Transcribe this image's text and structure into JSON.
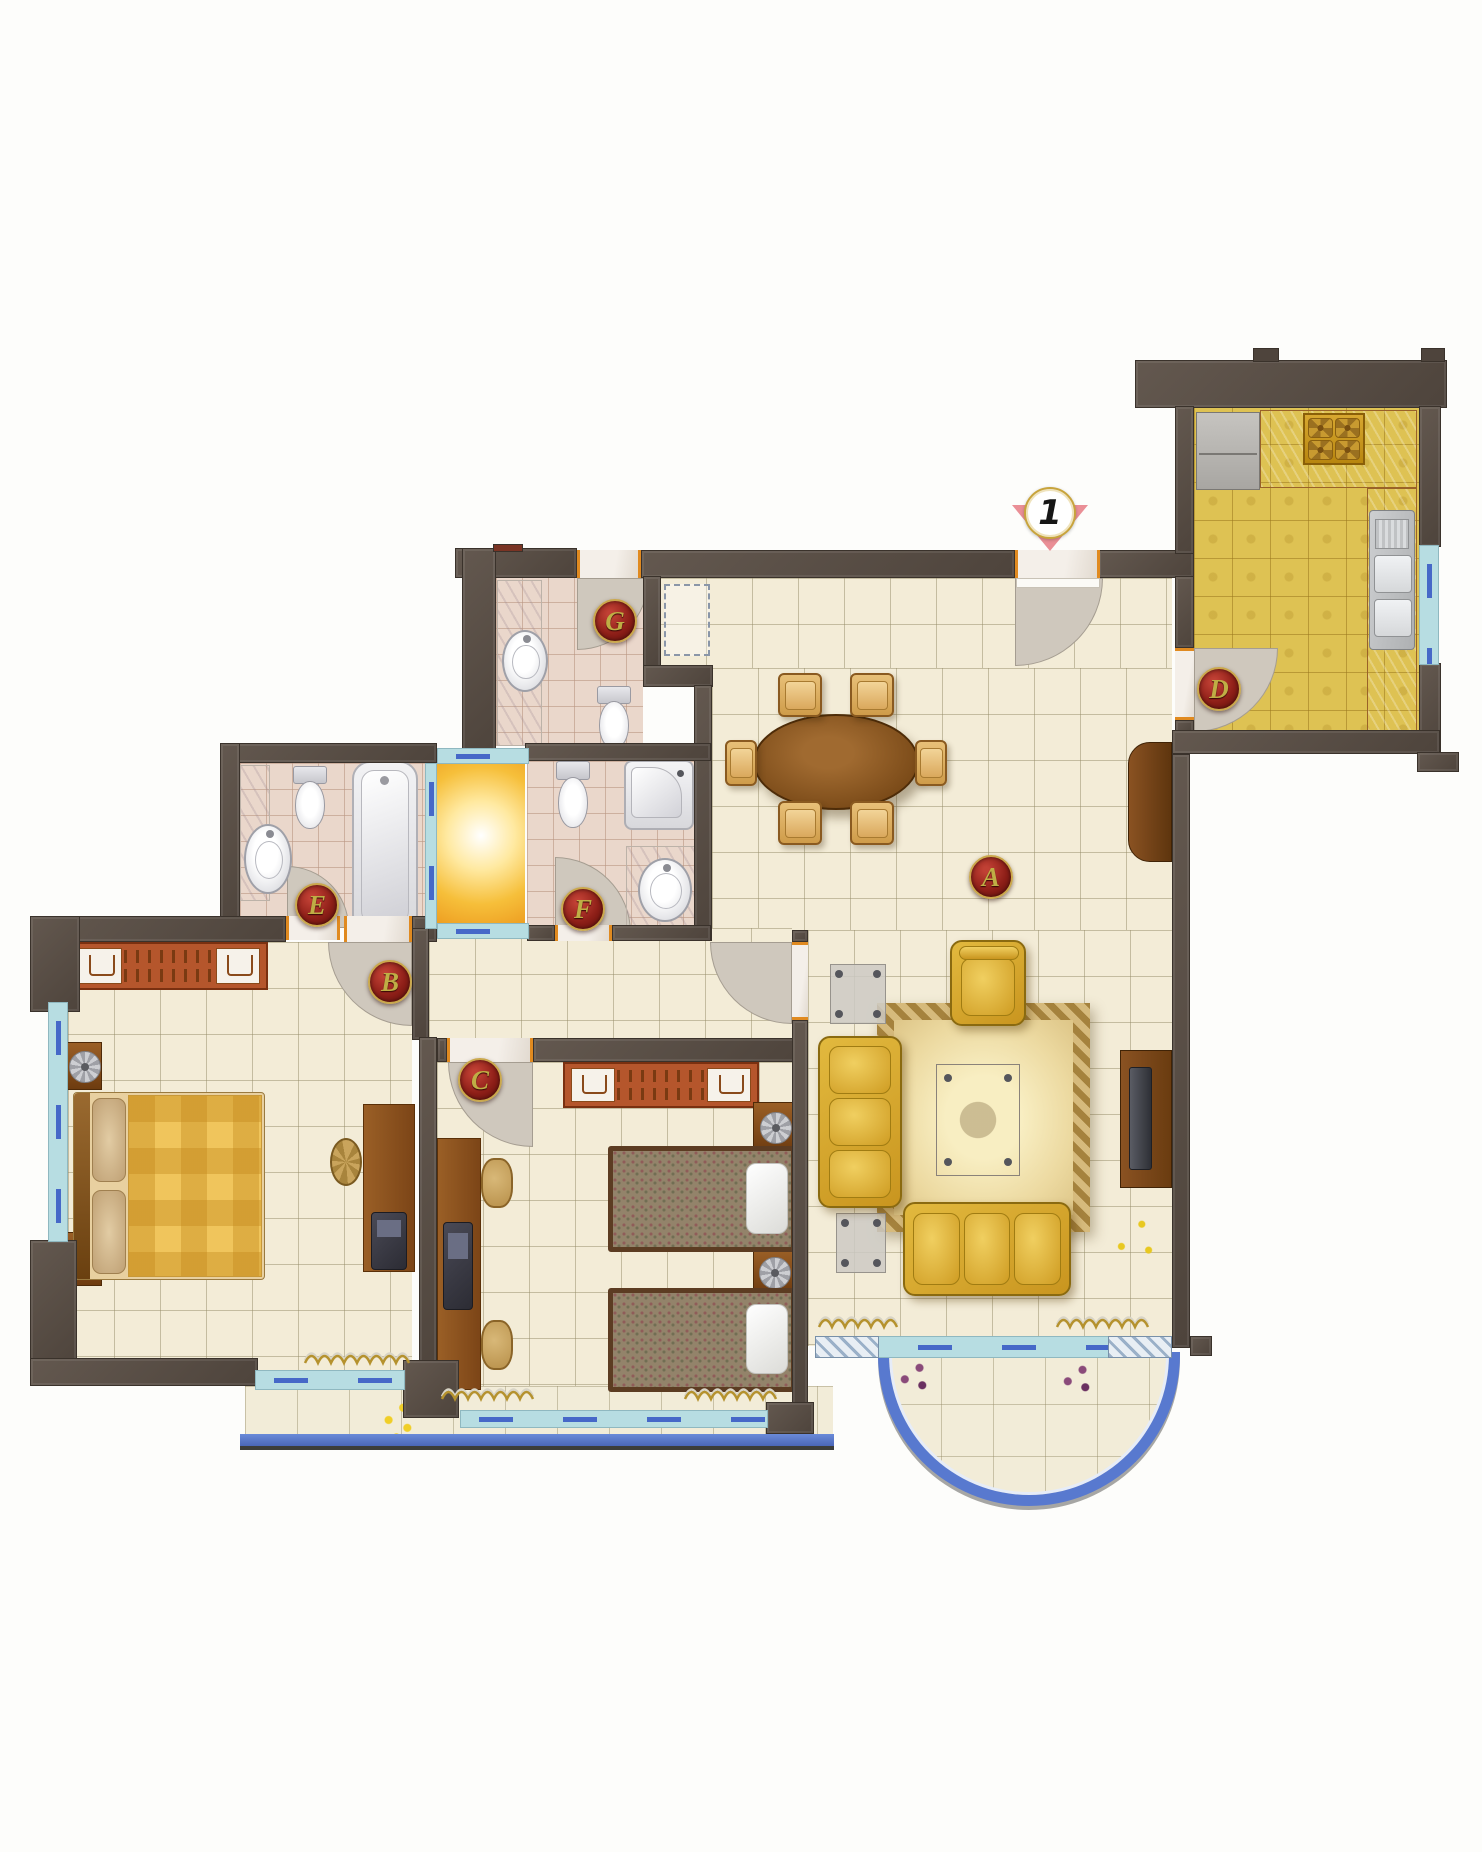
{
  "marker": {
    "text": "1",
    "x": 1050,
    "y": 513,
    "name": "entrance-marker"
  },
  "room_labels": [
    {
      "letter": "A",
      "x": 991,
      "y": 877,
      "name": "label-living-dining-A"
    },
    {
      "letter": "B",
      "x": 390,
      "y": 982,
      "name": "label-bedroom-master-B"
    },
    {
      "letter": "C",
      "x": 480,
      "y": 1080,
      "name": "label-bedroom-2-C"
    },
    {
      "letter": "D",
      "x": 1219,
      "y": 689,
      "name": "label-kitchen-D"
    },
    {
      "letter": "E",
      "x": 317,
      "y": 905,
      "name": "label-bath-e-E"
    },
    {
      "letter": "F",
      "x": 583,
      "y": 909,
      "name": "label-bath-f-F"
    },
    {
      "letter": "G",
      "x": 615,
      "y": 621,
      "name": "label-bath-g-G"
    }
  ],
  "colors": {
    "wall": "#574c44",
    "floor_cream": "#f3ecd7",
    "floor_bath": "#ead7cb",
    "floor_kitchen": "#dec253",
    "lightwell": "#f6bf3a",
    "window": "#b7dde2",
    "window_dash": "#4668c8",
    "balcony_edge": "#5879cf",
    "door_swing": "#cfc8bd",
    "label_red": "#8e1f18",
    "label_gold": "#bfae45",
    "marker_pink": "#ea8f96",
    "sofa_gold": "#d8a82c",
    "wood": "#8a5a2a",
    "wardrobe_orange": "#b5562c"
  },
  "floors": [
    [
      660,
      578,
      512,
      92,
      "cream",
      "foyer-floor"
    ],
    [
      712,
      668,
      460,
      272,
      "cream",
      "dining-floor"
    ],
    [
      808,
      930,
      364,
      416,
      "cream",
      "living-floor"
    ],
    [
      429,
      928,
      363,
      112,
      "cream",
      "hall-floor"
    ],
    [
      68,
      942,
      344,
      430,
      "cream",
      "bedroom-master-floor"
    ],
    [
      437,
      1062,
      355,
      348,
      "cream",
      "bedroom-2-floor"
    ],
    [
      496,
      576,
      147,
      170,
      "bath",
      "bath-g-floor"
    ],
    [
      527,
      761,
      167,
      164,
      "bath",
      "bath-f-floor"
    ],
    [
      240,
      763,
      185,
      154,
      "bath",
      "bath-e-floor"
    ],
    [
      1194,
      406,
      225,
      326,
      "kitchen",
      "kitchen-floor"
    ],
    [
      245,
      1386,
      588,
      50,
      "balcony",
      "balcony-left-floor"
    ],
    [
      437,
      764,
      88,
      159,
      "glow",
      "lightwell"
    ]
  ],
  "walls": [
    [
      455,
      548,
      122,
      30
    ],
    [
      641,
      550,
      374,
      28
    ],
    [
      1098,
      550,
      96,
      28
    ],
    [
      462,
      548,
      34,
      206
    ],
    [
      643,
      576,
      18,
      95
    ],
    [
      643,
      665,
      70,
      22
    ],
    [
      694,
      685,
      18,
      256
    ],
    [
      525,
      743,
      186,
      18
    ],
    [
      220,
      743,
      217,
      20
    ],
    [
      220,
      743,
      20,
      196
    ],
    [
      240,
      917,
      46,
      22
    ],
    [
      527,
      925,
      28,
      16
    ],
    [
      612,
      925,
      99,
      16
    ],
    [
      30,
      916,
      256,
      26
    ],
    [
      412,
      916,
      25,
      26
    ],
    [
      412,
      928,
      17,
      112
    ],
    [
      419,
      1037,
      18,
      357
    ],
    [
      437,
      1038,
      10,
      24
    ],
    [
      533,
      1038,
      269,
      24
    ],
    [
      792,
      930,
      16,
      12
    ],
    [
      792,
      1020,
      16,
      414
    ],
    [
      30,
      916,
      50,
      96
    ],
    [
      30,
      1240,
      47,
      128
    ],
    [
      30,
      1358,
      228,
      28
    ],
    [
      403,
      1360,
      56,
      58
    ],
    [
      766,
      1402,
      48,
      32
    ],
    [
      1135,
      360,
      312,
      48
    ],
    [
      1175,
      406,
      19,
      148
    ],
    [
      1175,
      576,
      19,
      72
    ],
    [
      1175,
      720,
      19,
      14
    ],
    [
      1419,
      406,
      22,
      141
    ],
    [
      1419,
      663,
      22,
      92
    ],
    [
      1172,
      730,
      268,
      24
    ],
    [
      1417,
      752,
      42,
      20
    ],
    [
      1172,
      754,
      18,
      594
    ],
    [
      1190,
      1336,
      22,
      20
    ]
  ],
  "caps": [
    [
      493,
      544,
      30,
      8,
      "#7a3424",
      "roof-cap-red"
    ],
    [
      1253,
      348,
      26,
      14,
      "#4e443c",
      "kitchen-wall-stub-1"
    ],
    [
      1421,
      348,
      24,
      14,
      "#4e443c",
      "kitchen-wall-stub-2"
    ]
  ],
  "windows": [
    [
      48,
      1002,
      20,
      240,
      "v",
      "bedroom-master-side-window"
    ],
    [
      255,
      1370,
      150,
      20,
      "h",
      "bedroom-master-balcony-window"
    ],
    [
      460,
      1410,
      308,
      18,
      "h",
      "bedroom-2-balcony-window"
    ],
    [
      815,
      1336,
      357,
      22,
      "h",
      "living-room-balcony-window"
    ],
    [
      815,
      1336,
      64,
      22,
      "hatch",
      "living-window-sill-left"
    ],
    [
      1108,
      1336,
      64,
      22,
      "hatch",
      "living-window-sill-right"
    ],
    [
      1419,
      545,
      20,
      120,
      "v",
      "kitchen-window"
    ],
    [
      425,
      763,
      12,
      166,
      "v",
      "lightwell-window-left"
    ],
    [
      437,
      748,
      92,
      16,
      "h",
      "lightwell-window-top"
    ],
    [
      437,
      923,
      92,
      16,
      "h",
      "lightwell-window-bottom"
    ]
  ],
  "door_swings": [
    [
      1015,
      578,
      88,
      "br",
      "entrance-door-swing"
    ],
    [
      1194,
      648,
      84,
      "br",
      "kitchen-door-swing"
    ],
    [
      577,
      578,
      72,
      "br",
      "bath-g-door-swing"
    ],
    [
      555,
      857,
      76,
      "tr",
      "bath-f-door-swing"
    ],
    [
      287,
      866,
      62,
      "tr",
      "bath-e-door-swing"
    ],
    [
      328,
      942,
      84,
      "bl",
      "bedroom-master-door-swing"
    ],
    [
      448,
      1062,
      85,
      "bl",
      "bedroom-2-door-swing"
    ],
    [
      710,
      942,
      82,
      "bl",
      "living-hall-door-swing"
    ]
  ],
  "thresholds": [
    [
      1015,
      550,
      85,
      28,
      0,
      "entrance-threshold"
    ],
    [
      577,
      550,
      64,
      28,
      0,
      "bath-g-threshold"
    ],
    [
      1175,
      648,
      19,
      72,
      1,
      "kitchen-threshold"
    ],
    [
      286,
      916,
      54,
      24,
      0,
      "bath-e-threshold"
    ],
    [
      344,
      916,
      68,
      26,
      0,
      "bedroom-master-threshold"
    ],
    [
      555,
      925,
      57,
      16,
      0,
      "bath-f-threshold"
    ],
    [
      447,
      1038,
      86,
      24,
      0,
      "bedroom-2-threshold"
    ],
    [
      792,
      942,
      16,
      78,
      1,
      "living-hall-threshold"
    ]
  ],
  "leafs": [
    [
      1016,
      578,
      84,
      10,
      "entrance-door-leaf"
    ]
  ],
  "dashed_boxes": [
    [
      664,
      584,
      46,
      72,
      "foyer-closet-outline"
    ]
  ],
  "furniture": [
    [
      "rug",
      877,
      1003,
      213,
      229,
      "living-rug"
    ],
    [
      "fridge",
      1196,
      412,
      64,
      78,
      "kitchen-fridge"
    ],
    [
      "counter",
      1260,
      410,
      157,
      78,
      "kitchen-counter-top"
    ],
    [
      "stove",
      1303,
      413,
      62,
      52,
      "kitchen-stove"
    ],
    [
      "counter",
      1367,
      488,
      50,
      244,
      "kitchen-counter-right"
    ],
    [
      "sink",
      1369,
      510,
      46,
      140,
      "kitchen-sink"
    ],
    [
      "marble",
      497,
      580,
      45,
      166,
      "bath-g-counter"
    ],
    [
      "basin",
      502,
      630,
      46,
      62,
      "bath-g-basin"
    ],
    [
      "toilet",
      594,
      686,
      38,
      62,
      "bath-g-toilet"
    ],
    [
      "toilet",
      553,
      761,
      38,
      66,
      "bath-f-toilet"
    ],
    [
      "shower",
      624,
      760,
      70,
      70,
      "bath-f-shower"
    ],
    [
      "marble",
      626,
      846,
      82,
      90,
      "bath-f-counter"
    ],
    [
      "basin",
      638,
      858,
      54,
      64,
      "bath-f-basin"
    ],
    [
      "marble",
      240,
      765,
      30,
      136,
      "bath-e-counter"
    ],
    [
      "basin",
      244,
      824,
      48,
      70,
      "bath-e-basin"
    ],
    [
      "toilet",
      290,
      766,
      38,
      62,
      "bath-e-toilet"
    ],
    [
      "tub",
      352,
      761,
      66,
      172,
      "bath-e-tub"
    ],
    [
      "ward",
      70,
      942,
      198,
      48,
      "master-wardrobe"
    ],
    [
      "nstand",
      66,
      1042,
      36,
      48,
      "master-nightstand-top"
    ],
    [
      "nstand",
      66,
      1232,
      36,
      54,
      "master-nightstand-bottom"
    ],
    [
      "bedm",
      73,
      1092,
      192,
      188,
      "master-bed"
    ],
    [
      "desk",
      363,
      1104,
      52,
      168,
      "master-desk"
    ],
    [
      "stool",
      330,
      1138,
      32,
      48,
      "master-desk-stool"
    ],
    [
      "laptop",
      371,
      1212,
      36,
      58,
      "master-desk-chair"
    ],
    [
      "ward",
      563,
      1062,
      196,
      46,
      "bedroom2-wardrobe"
    ],
    [
      "desk",
      437,
      1138,
      44,
      252,
      "bedroom2-desk"
    ],
    [
      "chairw",
      481,
      1158,
      32,
      50,
      "bedroom2-chair-top"
    ],
    [
      "chairw",
      481,
      1320,
      32,
      50,
      "bedroom2-chair-bottom"
    ],
    [
      "laptop",
      443,
      1222,
      30,
      88,
      "bedroom2-desk-items"
    ],
    [
      "nstand",
      753,
      1102,
      44,
      50,
      "bedroom2-nightstand-top"
    ],
    [
      "nstand",
      753,
      1250,
      42,
      44,
      "bedroom2-nightstand-bottom"
    ],
    [
      "bedt",
      608,
      1146,
      188,
      106,
      "bedroom2-bed-top"
    ],
    [
      "bedt",
      608,
      1288,
      188,
      104,
      "bedroom2-bed-bottom"
    ],
    [
      "dtable",
      753,
      714,
      166,
      96,
      "dining-table"
    ],
    [
      "dchair",
      778,
      673,
      44,
      44,
      "dining-chair-1"
    ],
    [
      "dchair",
      850,
      673,
      44,
      44,
      "dining-chair-2"
    ],
    [
      "dchair",
      778,
      801,
      44,
      44,
      "dining-chair-3"
    ],
    [
      "dchair",
      850,
      801,
      44,
      44,
      "dining-chair-4"
    ],
    [
      "dchair",
      725,
      740,
      32,
      46,
      "dining-chair-5"
    ],
    [
      "dchair",
      915,
      740,
      32,
      46,
      "dining-chair-6"
    ],
    [
      "sideboard",
      1128,
      742,
      44,
      120,
      "dining-sideboard"
    ],
    [
      "etable",
      830,
      964,
      56,
      60,
      "living-side-table-top"
    ],
    [
      "etable",
      836,
      1213,
      50,
      60,
      "living-side-table-bottom"
    ],
    [
      "armchair",
      950,
      940,
      76,
      86,
      "living-armchair"
    ],
    [
      "sofav",
      818,
      1036,
      84,
      172,
      "living-sofa-left"
    ],
    [
      "sofah",
      903,
      1202,
      168,
      94,
      "living-sofa-front"
    ],
    [
      "ctable",
      936,
      1064,
      84,
      112,
      "living-coffee-table"
    ],
    [
      "tvcab",
      1120,
      1050,
      52,
      138,
      "living-tv-cabinet"
    ],
    [
      "plantg",
      1101,
      1202,
      68,
      74,
      "plant-green"
    ],
    [
      "plantp",
      891,
      1354,
      46,
      46,
      "plant-purple-left"
    ],
    [
      "plantp",
      1054,
      1356,
      46,
      46,
      "plant-purple-right"
    ],
    [
      "planty",
      373,
      1392,
      52,
      56,
      "plant-yellow-flowers"
    ]
  ],
  "curtains": [
    [
      303,
      1352,
      108,
      "curtain-master"
    ],
    [
      440,
      1388,
      100,
      "curtain-bedroom2-left"
    ],
    [
      683,
      1388,
      107,
      "curtain-bedroom2-right"
    ],
    [
      817,
      1316,
      82,
      "curtain-living-left"
    ],
    [
      1055,
      1316,
      107,
      "curtain-living-right"
    ]
  ],
  "balcony_right": {
    "x": 878,
    "y": 1352,
    "w": 302,
    "h": 154,
    "name": "balcony-curved"
  },
  "balcony_left_band": {
    "x": 240,
    "y": 1434,
    "w": 594,
    "h": 16,
    "name": "balcony-left-edge"
  }
}
